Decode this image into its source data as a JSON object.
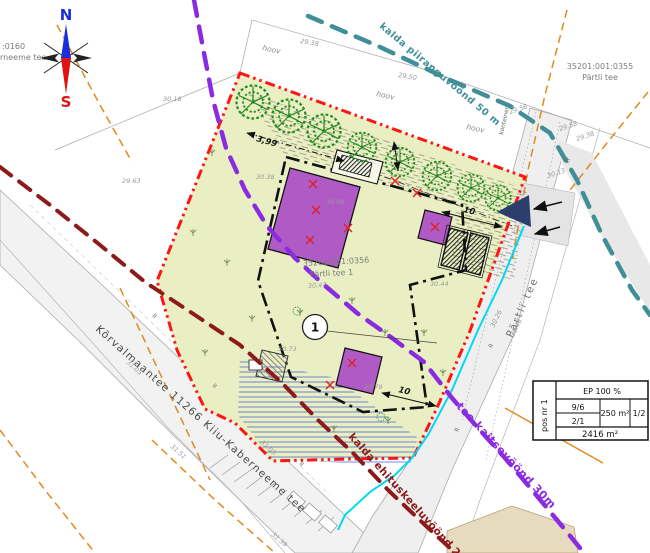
{
  "compass": {
    "north": "N",
    "south": "S"
  },
  "parcels": {
    "left_code": ":0160",
    "left_name": "rneeme tee",
    "right_code": "35201:001:0355",
    "right_name": "Pärtli tee",
    "center_code": "35201:001:0356",
    "center_name": "Pärtli tee 1",
    "center_elev": "30.47"
  },
  "roads": {
    "main": "Kõrvalmaantee 11266 Kiiu-Kaberneeme tee",
    "right": "Pärtli tee"
  },
  "zones": {
    "shore_restriction": "kalda piiranguvöönd 50 m",
    "road_protection": "tee kaitsevöönd 30m",
    "shore_building_ban": "kalda ehituskeeluvöönd 25m"
  },
  "position": {
    "number": "1"
  },
  "dimensions": {
    "setback": "3,99",
    "width_right": "10",
    "width_bottom": "10"
  },
  "site_labels": {
    "yard": "hoov",
    "container": "konteiner",
    "ditch": "kr",
    "slope_tick": "II"
  },
  "elevations": [
    "29.38",
    "29.50",
    "30.18",
    "29.63",
    "30.38",
    "30.86",
    "30.73",
    "30.78",
    "29.56",
    "29.58",
    "29.38",
    "30.26",
    "30.48",
    "31.05",
    "31.51",
    "31.08",
    "31.39",
    "30.44",
    "30.13"
  ],
  "info_table": {
    "pos": "pos nr 1",
    "usage": "EP 100 %",
    "storeys": "9/6",
    "ratio2": "2/1",
    "building_area": "250 m²",
    "height": "1/2",
    "plot_area": "2416 m²"
  },
  "colors": {
    "boundary_red": "#ff1414",
    "building_purple": "#b05ac6",
    "zone_teal": "#3f8e98",
    "zone_violet": "#8a2be2",
    "zone_darkred": "#8c1a1a",
    "cadastral_orange": "#e08a1e",
    "utility_cyan": "#00d9f2",
    "parcel_green": "#e9efc3",
    "entrance_navy": "#2c3e6b"
  }
}
